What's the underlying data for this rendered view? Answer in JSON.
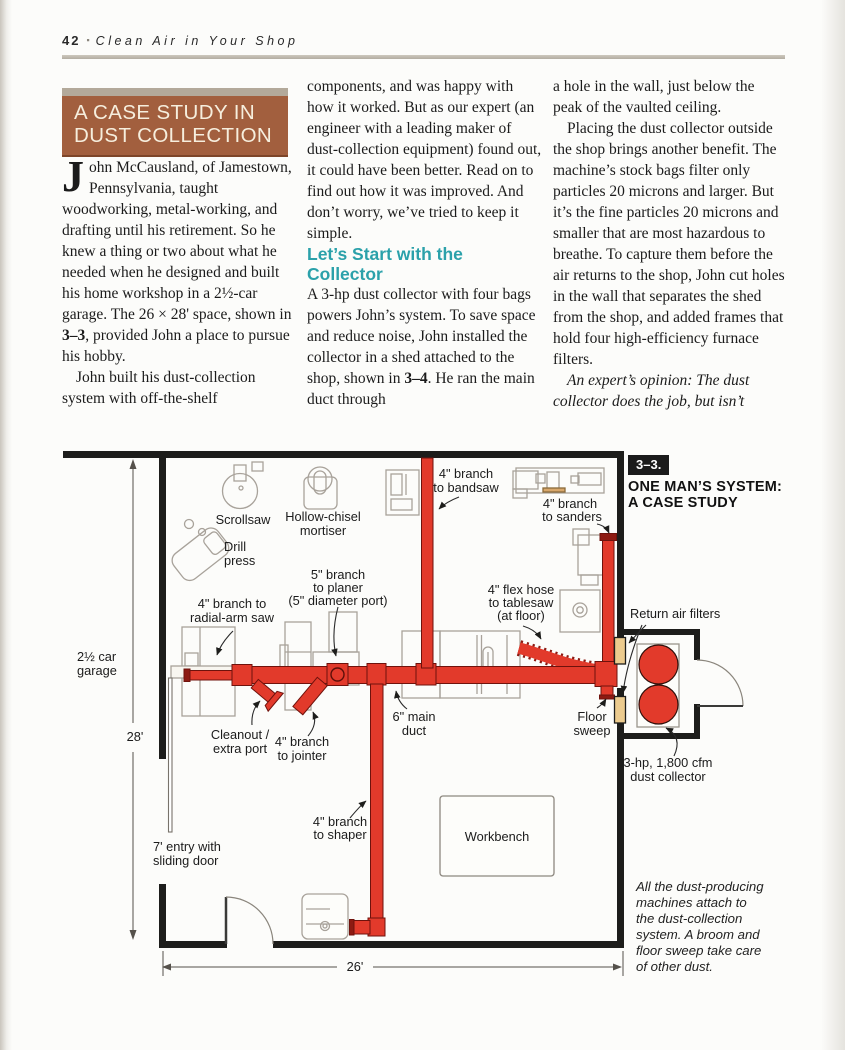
{
  "header": {
    "page_number": "42",
    "bullet": "▪",
    "title": "Clean Air in Your Shop"
  },
  "case_study_box": {
    "line1": "A CASE STUDY IN",
    "line2": "DUST COLLECTION"
  },
  "columns": {
    "col1_dropcap": "J",
    "col1_p1a": "ohn McCausland, of Jamestown, Pennsylvania, taught woodworking, metal-working, and drafting until his retirement. So he knew a thing or two about what he needed when he designed and built his home workshop in a 2½-car garage. The 26 × 28' space, shown in ",
    "col1_p1_ref": "3–3",
    "col1_p1b": ", provided John a place to pursue his hobby.",
    "col1_p2": "John built his dust-collection system with off-the-shelf",
    "col2_p1": "components, and was happy with how it worked. But as our expert (an engineer with a leading maker of dust-collection equipment) found out, it could have been better. Read on to find out how it was improved. And don’t worry, we’ve tried to keep it simple.",
    "col2_heading": "Let’s Start with the Collector",
    "col2_p2a": "A 3-hp dust collector with four bags powers John’s system. To save space and reduce noise, John installed the collector in a shed attached to the shop, shown in ",
    "col2_p2_ref": "3–4",
    "col2_p2b": ". He ran the main duct through",
    "col3_p1": "a hole in the wall, just below the peak of the vaulted ceiling.",
    "col3_p2": "Placing the dust collector outside the shop brings another benefit. The machine’s stock bags filter only particles 20 microns and larger. But it’s the fine particles 20 microns and smaller that are most hazardous to breathe. To capture them before the air returns to the shop, John cut holes in the wall that separates the shed from the shop, and added frames that hold four high-efficiency furnace filters.",
    "col3_p3": "An expert’s opinion: The dust collector does the job, but isn’t"
  },
  "figure": {
    "tag": "3–3.",
    "title1": "ONE MAN’S SYSTEM:",
    "title2": "A CASE STUDY",
    "caption": [
      "All the dust-producing",
      "machines attach to",
      "the dust-collection",
      "system. A broom and",
      "floor sweep take care",
      "of other dust."
    ],
    "labels": {
      "scrollsaw": "Scrollsaw",
      "mortiser1": "Hollow-chisel",
      "mortiser2": "mortiser",
      "drill1": "Drill",
      "drill2": "press",
      "radial1": "4\" branch to",
      "radial2": "radial-arm saw",
      "planer1": "5\" branch",
      "planer2": "to planer",
      "planer3": "(5\" diameter port)",
      "bandsaw1": "4\" branch",
      "bandsaw2": "to bandsaw",
      "sanders1": "4\" branch",
      "sanders2": "to sanders",
      "flex1": "4\" flex hose",
      "flex2": "to tablesaw",
      "flex3": "(at floor)",
      "main1": "6\" main",
      "main2": "duct",
      "sweep1": "Floor",
      "sweep2": "sweep",
      "cleanout1": "Cleanout /",
      "cleanout2": "extra port",
      "jointer1": "4\" branch",
      "jointer2": "to jointer",
      "shaper1": "4\" branch",
      "shaper2": "to shaper",
      "workbench": "Workbench",
      "entry1": "7' entry with",
      "entry2": "sliding door",
      "garage1": "2½ car",
      "garage2": "garage",
      "dim_v": "28'",
      "dim_h": "26'",
      "filters": "Return air filters",
      "collector1": "3-hp, 1,800 cfm",
      "collector2": "dust collector"
    },
    "colors": {
      "duct_red": "#e23a2b",
      "duct_dark": "#8d1a12",
      "filter_tan": "#eccb8e",
      "wall_black": "#1d1d1b",
      "machine_gray": "#a8a29a",
      "accent_teal": "#2ba1aa",
      "box_brown": "#a25f3e"
    }
  }
}
